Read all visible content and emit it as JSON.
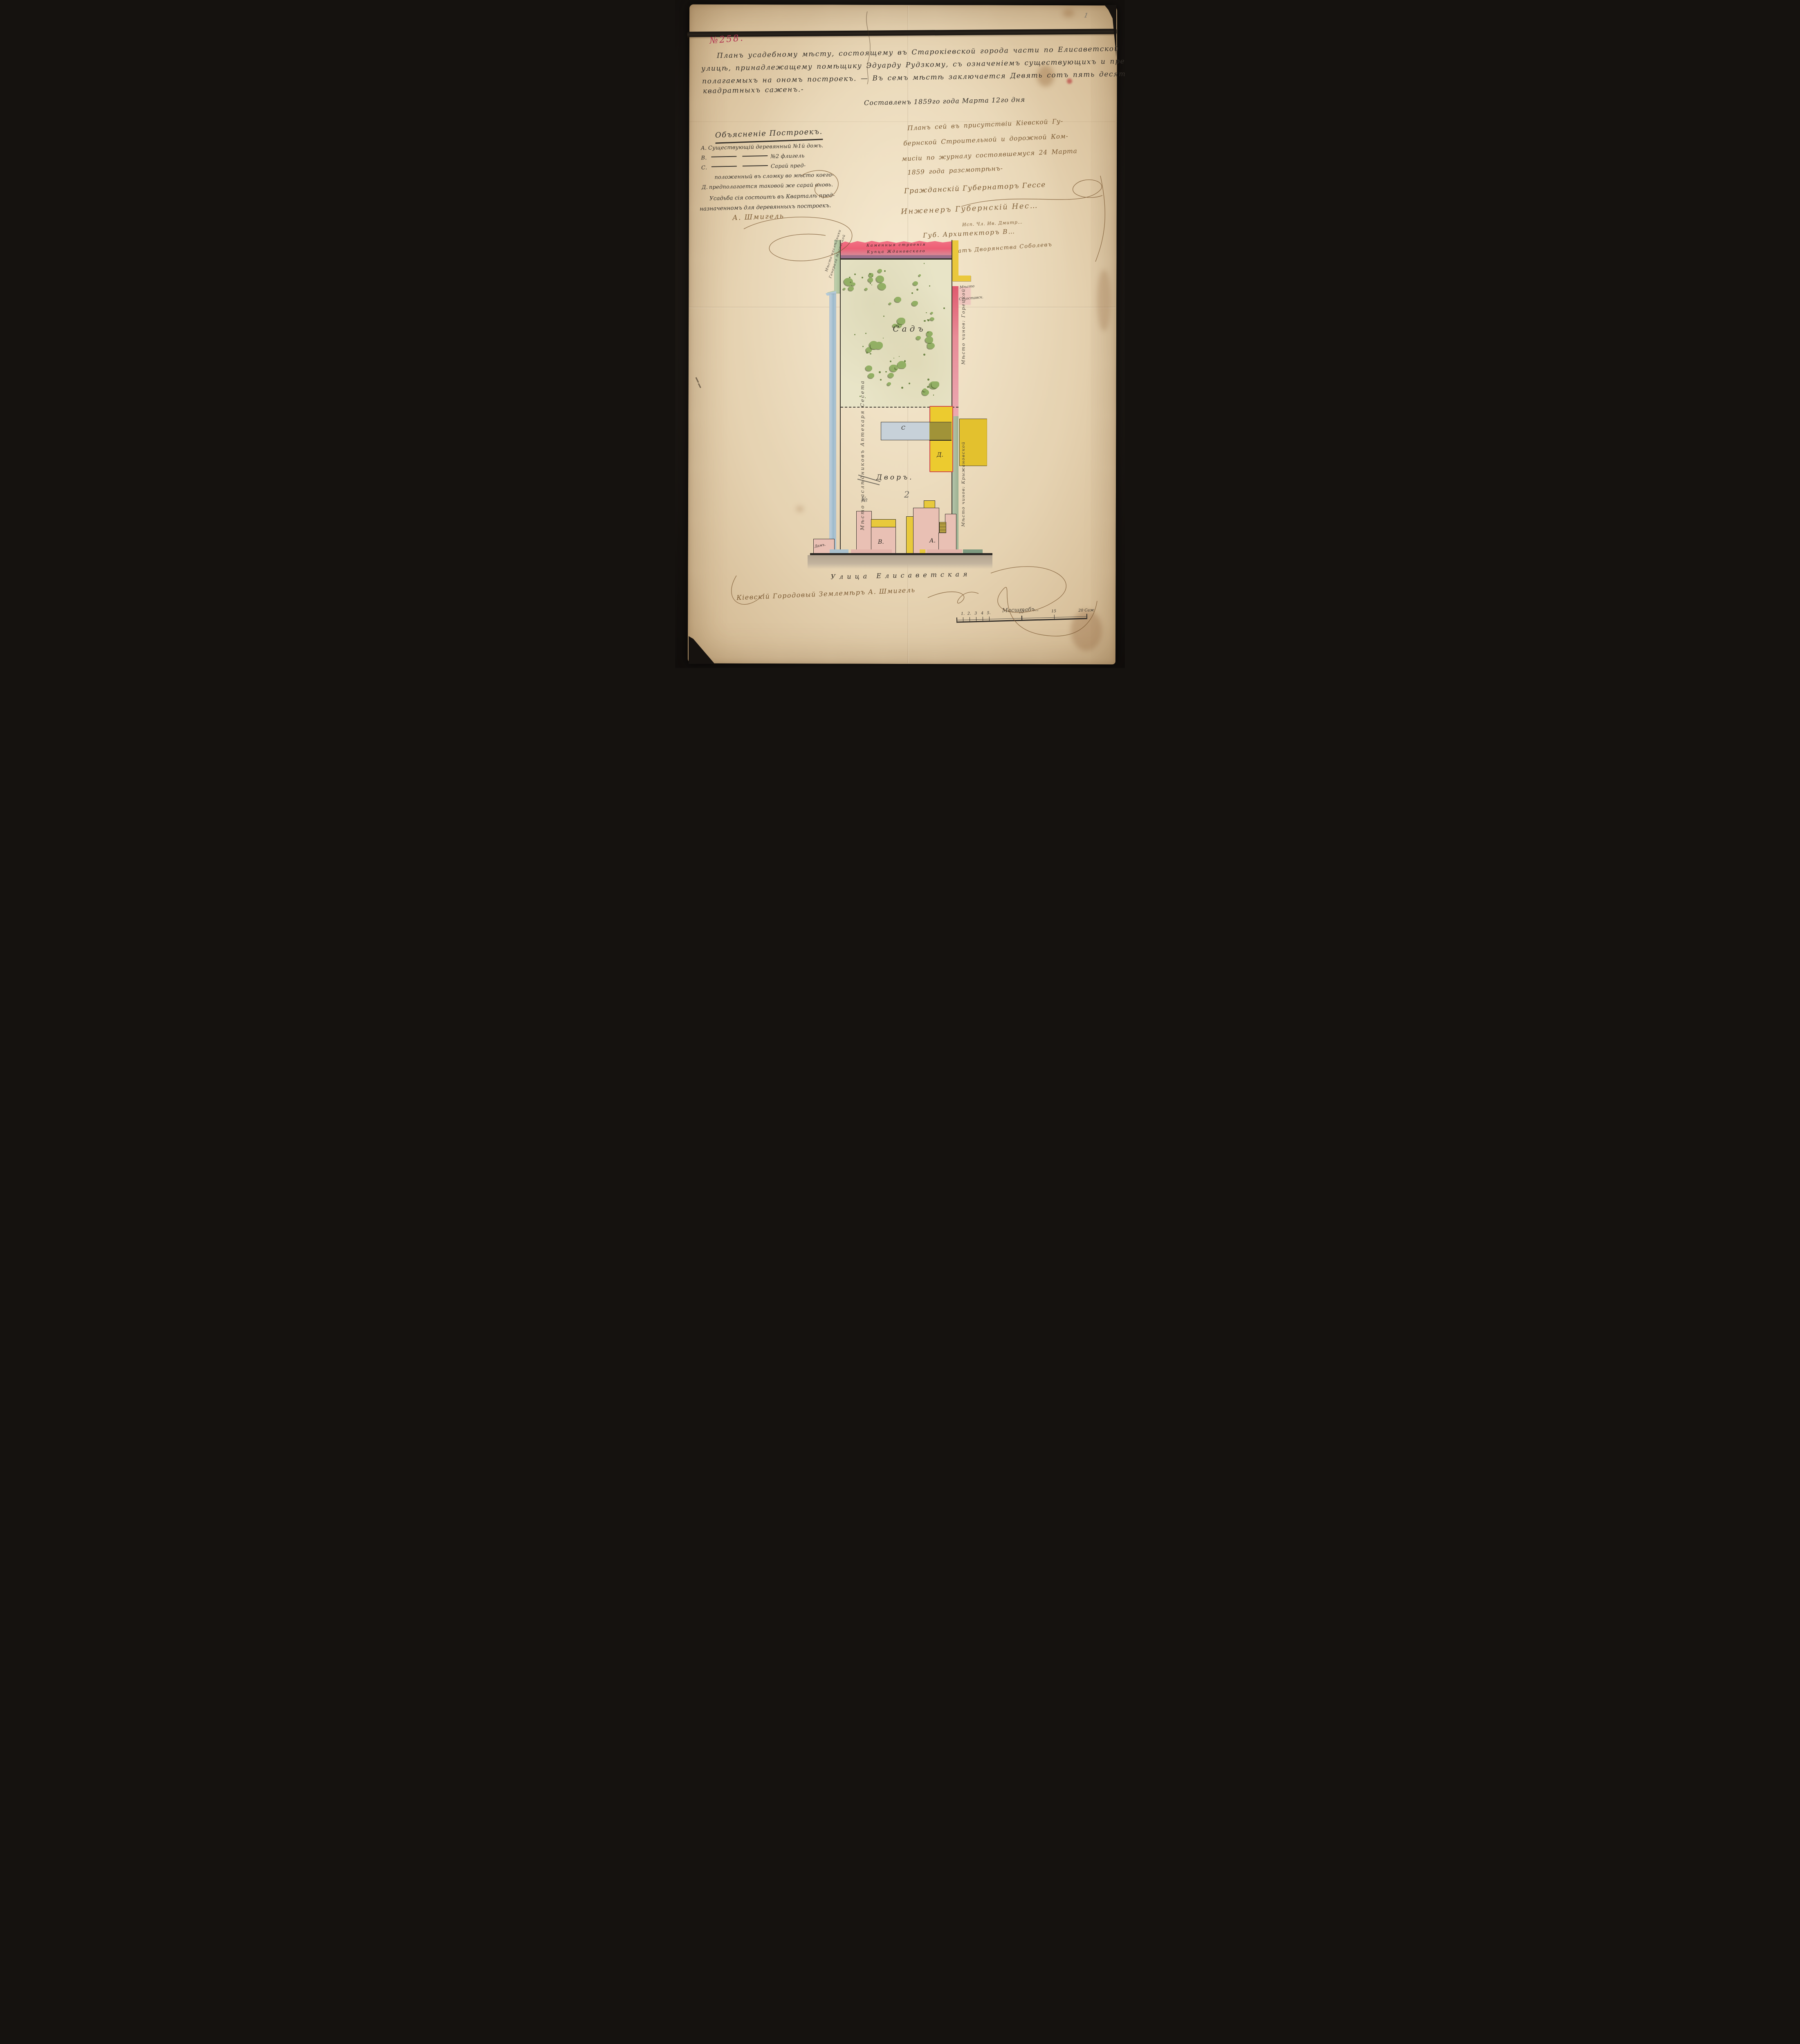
{
  "page": {
    "pencil_mark": "1"
  },
  "header": {
    "doc_number": "№258.",
    "title_lines": [
      "Планъ усадебному мѣсту, состоящему въ Старокіевской города части по Елисаветской",
      "улицѣ, принадлежащему помѣщику Эдуарду Рудзкому, съ означеніемъ существующихъ и пред-",
      "полагаемыхъ на ономъ построекъ. — Въ семъ мѣстѣ заключается Девять сотъ пять десятъ",
      "квадратныхъ саженъ.-"
    ],
    "date_line": "Составленъ 1859го года Марта 12го дня"
  },
  "legend": {
    "heading": "Объясненіе Построекъ.",
    "items": [
      {
        "letter": "А.",
        "ditto": false,
        "text": "Существующій деревянный №1й домъ."
      },
      {
        "letter": "В.",
        "ditto": true,
        "text": "№2 флигель"
      },
      {
        "letter": "С.",
        "ditto": true,
        "text": "Сарай пред-"
      },
      {
        "letter": "",
        "ditto": false,
        "text": "положенный въ сломку во мѣсто коего-"
      },
      {
        "letter": "Д.",
        "ditto": false,
        "text": "предполагается таковой же сарай вновь."
      }
    ],
    "note_lines": [
      "Усадьба сія состоитъ въ Кварталѣ пред-",
      "назначенномъ для деревянныхъ построекъ."
    ],
    "signature": "А. Шмигель"
  },
  "approval": {
    "lines": [
      "Планъ сей въ присутствіи Кіевской Гу-",
      "бернской Строительной и дорожной Ком-",
      "мисіи по журналу состоявшемуся 24 Марта",
      "1859 года разсмотрѣнъ-"
    ],
    "governor": "Гражданскій Губернаторъ Гессе",
    "engineer": "Инженеръ Губернскій Нес…",
    "member": "Исп. Чл. Ив. Дмитр…",
    "architect": "Губ. Архитекторъ В…",
    "deputy": "Депутатъ Дворянства Соболевъ"
  },
  "plan": {
    "north_building_lines": [
      "Каменныя строенія",
      "Купца Ждановскаго"
    ],
    "neighbor_top_right_lines": [
      "Мѣсто",
      "Сухоставск."
    ],
    "neighbor_left_top_lines": [
      "Мѣсто наслѣдники",
      "Генерала Мисевской"
    ],
    "neighbor_left": "Мѣсто наслѣдниковъ Аптекаря Сесета",
    "neighbor_right_upper": "Мѣсто чинов: Горецкой",
    "neighbor_right_lower": "Мѣсто чинов: Крыжановской",
    "garden_label": "Садъ",
    "courtyard_crossed": "№",
    "courtyard_label": "Дворъ.",
    "courtyard_number": "2",
    "buildings": {
      "a": "А.",
      "b": "В.",
      "c": "С",
      "d": "Д.",
      "small_house": "Дамъ."
    },
    "street": "Улица Елисаветская"
  },
  "footer": {
    "surveyor": "Кіевскій Городовый Землемѣръ А. Шмигель",
    "scale_label": "Масштабъ..",
    "scale_ticks": [
      {
        "label": "1.",
        "pct": 5
      },
      {
        "label": "2.",
        "pct": 10
      },
      {
        "label": "3",
        "pct": 15
      },
      {
        "label": "4",
        "pct": 20
      },
      {
        "label": "5.",
        "pct": 25
      },
      {
        "label": "10",
        "pct": 50
      },
      {
        "label": "15",
        "pct": 75
      },
      {
        "label": "20 Саж",
        "pct": 100
      }
    ]
  },
  "colors": {
    "paper": "#e9d8ba",
    "ink": "#35302a",
    "brown_ink": "#7b5a33",
    "red_ink": "#b13551",
    "north_strip_red": "#ed5f75",
    "yellow_building": "#eccb2f",
    "blue_building": "#c7d1d9",
    "overlap_olive": "#a19338",
    "pink_building": "#e9c0b4",
    "garden_tree_green": "#92af64",
    "left_border_blue": "#9db9cb",
    "border_green": "#a9bd95"
  }
}
